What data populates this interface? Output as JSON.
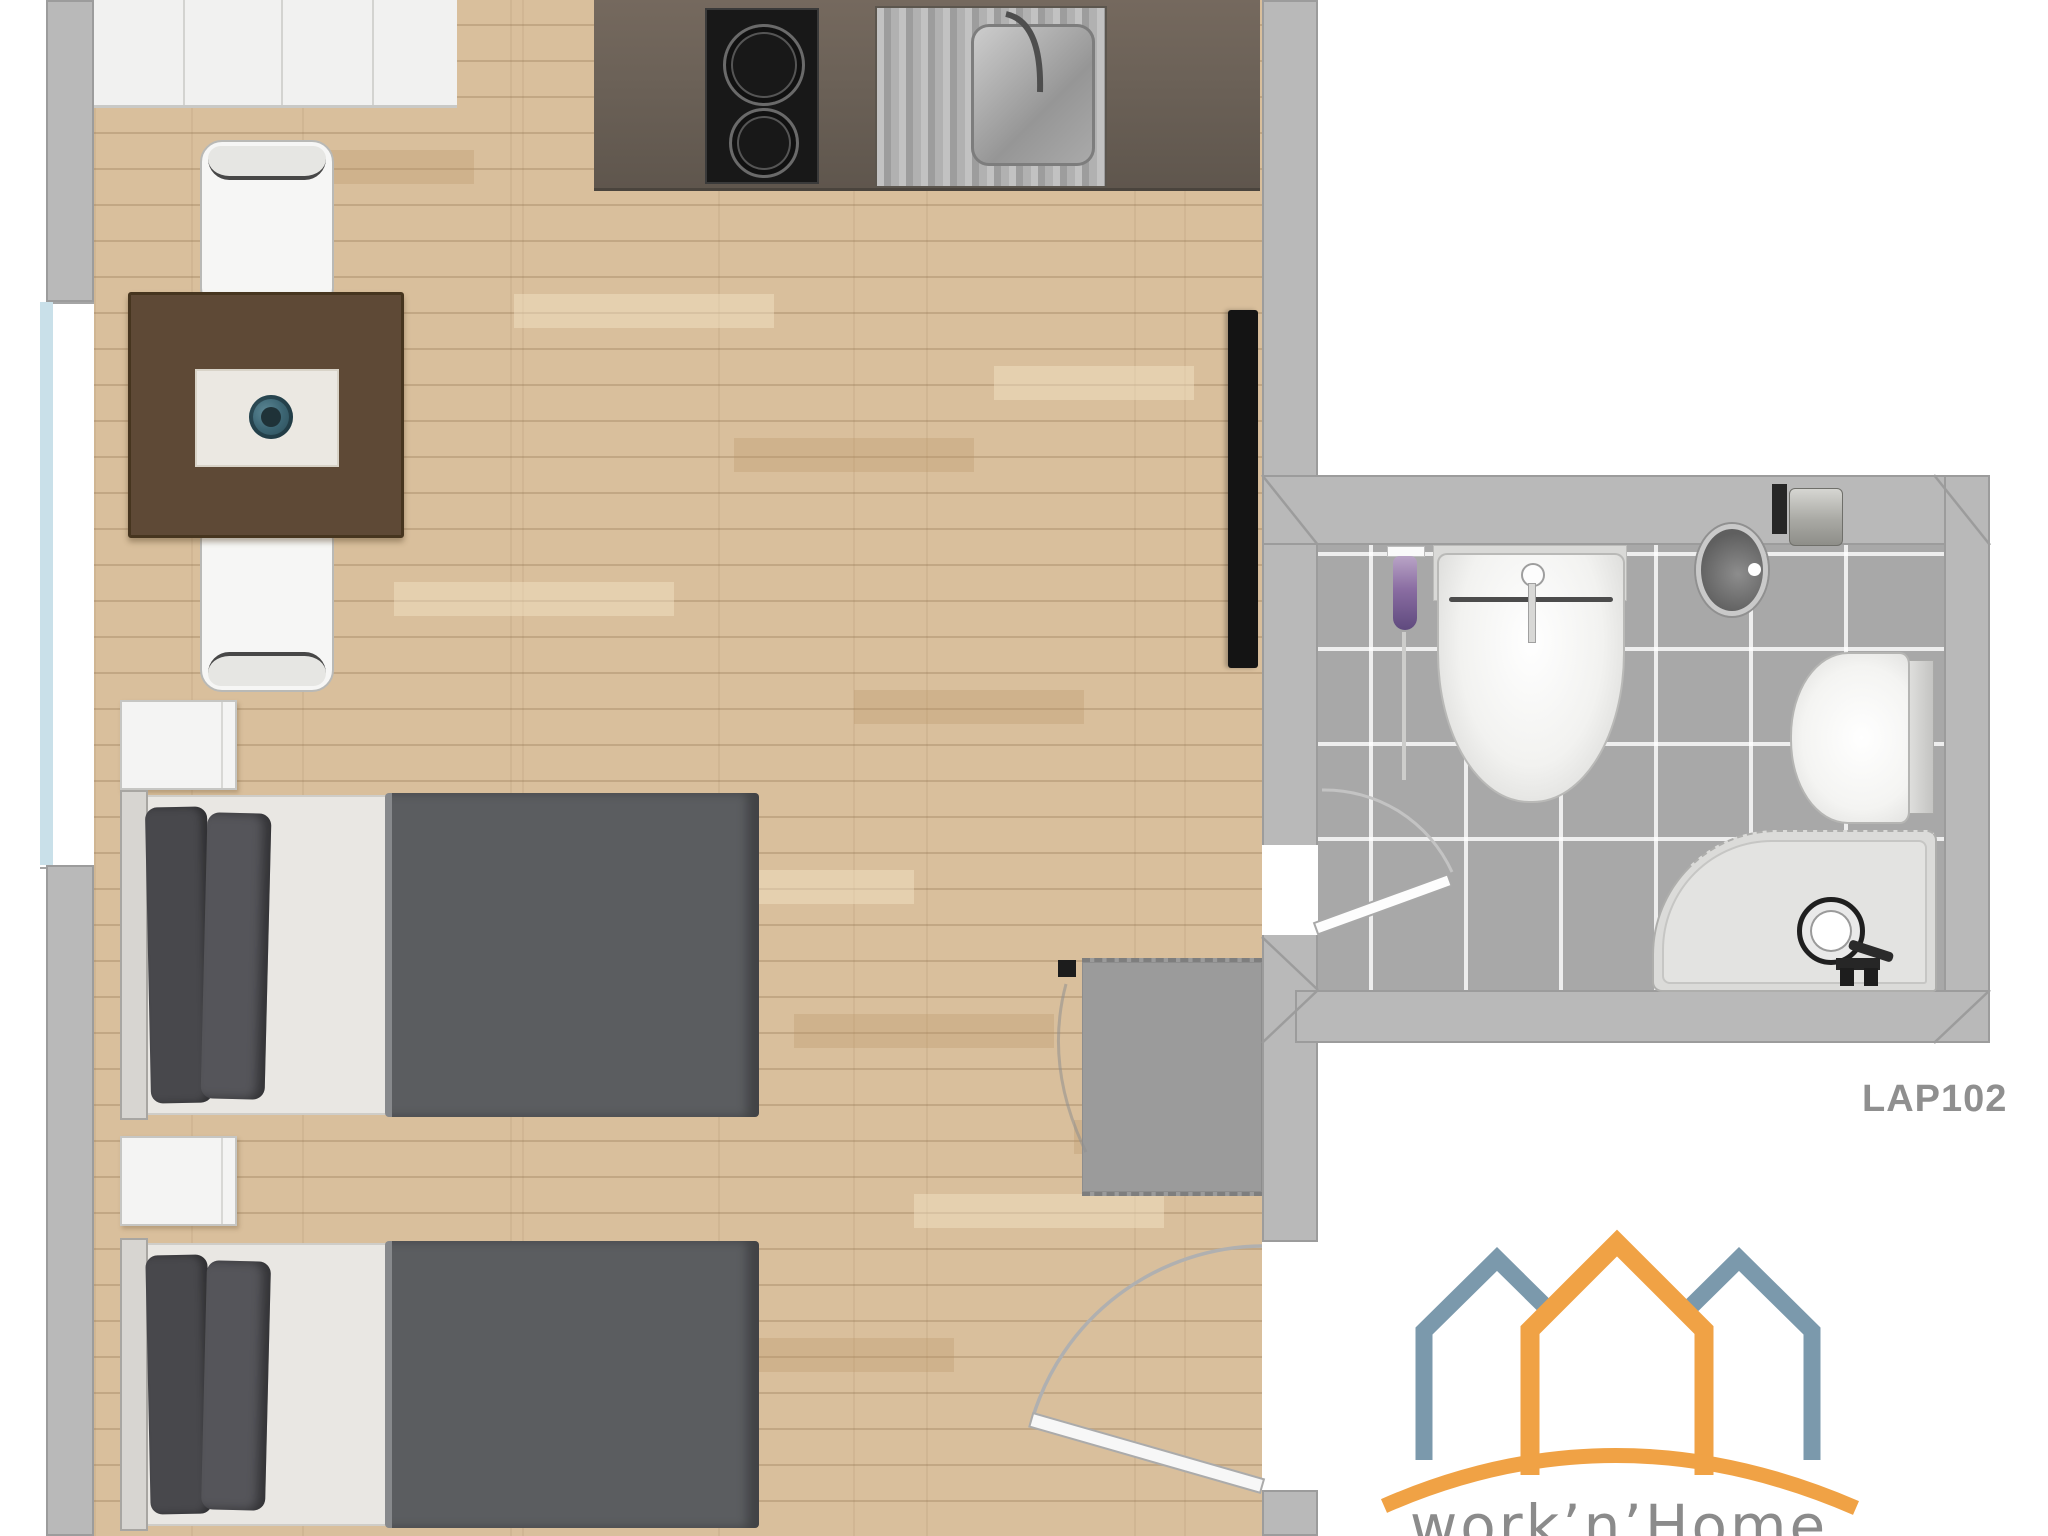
{
  "plan": {
    "unit_label": "LAP102",
    "brand": {
      "logo_text": "work’n’Home",
      "logo_orange": "#f0a245",
      "logo_blue": "#7b99ac",
      "logo_text_gray": "#8b8b8b"
    },
    "colors": {
      "background": "#ffffff",
      "wall_gray": "#b9b9b9",
      "wood_floor": "#d9bf9c",
      "bathroom_tile": "#a8a8a8",
      "kitchen_counter": "#6b6157",
      "bed_blanket": "#5b5d60",
      "bed_pillow": "#4e4e52",
      "table_brown": "#5e4936",
      "plant_teal": "#3c6573",
      "window_glass": "#c9e0e9",
      "label_gray": "#8f8f8f"
    },
    "rooms": {
      "main_room": "living / sleeping room with kitchenette",
      "bathroom": "tiled bathroom",
      "entry": "entry nook with door swing"
    },
    "fixtures": [
      "wardrobe-cabinets",
      "cooktop",
      "kitchen-sink",
      "dining-table",
      "chair",
      "chair",
      "bed",
      "bed",
      "nightstand",
      "nightstand",
      "tv",
      "rug",
      "toilet-brush",
      "wash-basin",
      "mirror",
      "toilet-paper-holder",
      "toilet",
      "corner-shower",
      "window",
      "entry-door",
      "bathroom-door"
    ]
  }
}
